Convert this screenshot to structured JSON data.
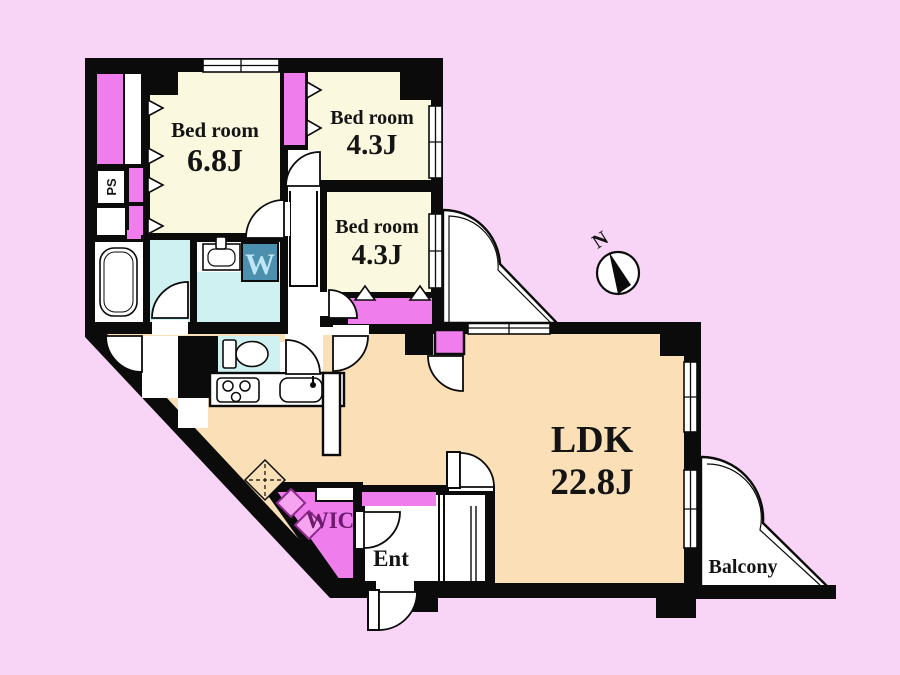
{
  "colors": {
    "background": "#F8D5F6",
    "wall": "#0B0B0B",
    "cream": "#FAF8DE",
    "peach": "#FBDFB6",
    "magenta": "#EF7EEC",
    "cyan": "#CFF1F1",
    "white": "#FFFFFF",
    "washer_bg": "#4D8FAF",
    "washer_letter": "#BEE6F4",
    "wic_text": "#6E1A6E"
  },
  "rooms": {
    "bedroom1": {
      "name": "Bed room",
      "size": "6.8J"
    },
    "bedroom2": {
      "name": "Bed room",
      "size": "4.3J"
    },
    "bedroom3": {
      "name": "Bed room",
      "size": "4.3J"
    },
    "ldk": {
      "name": "LDK",
      "size": "22.8J"
    },
    "wic": {
      "label": "WIC"
    },
    "entrance": {
      "label": "Ent"
    },
    "balcony": {
      "label": "Balcony"
    },
    "pipe_space": {
      "label": "PS"
    },
    "washer": {
      "label": "W"
    }
  },
  "compass": {
    "label": "N"
  }
}
